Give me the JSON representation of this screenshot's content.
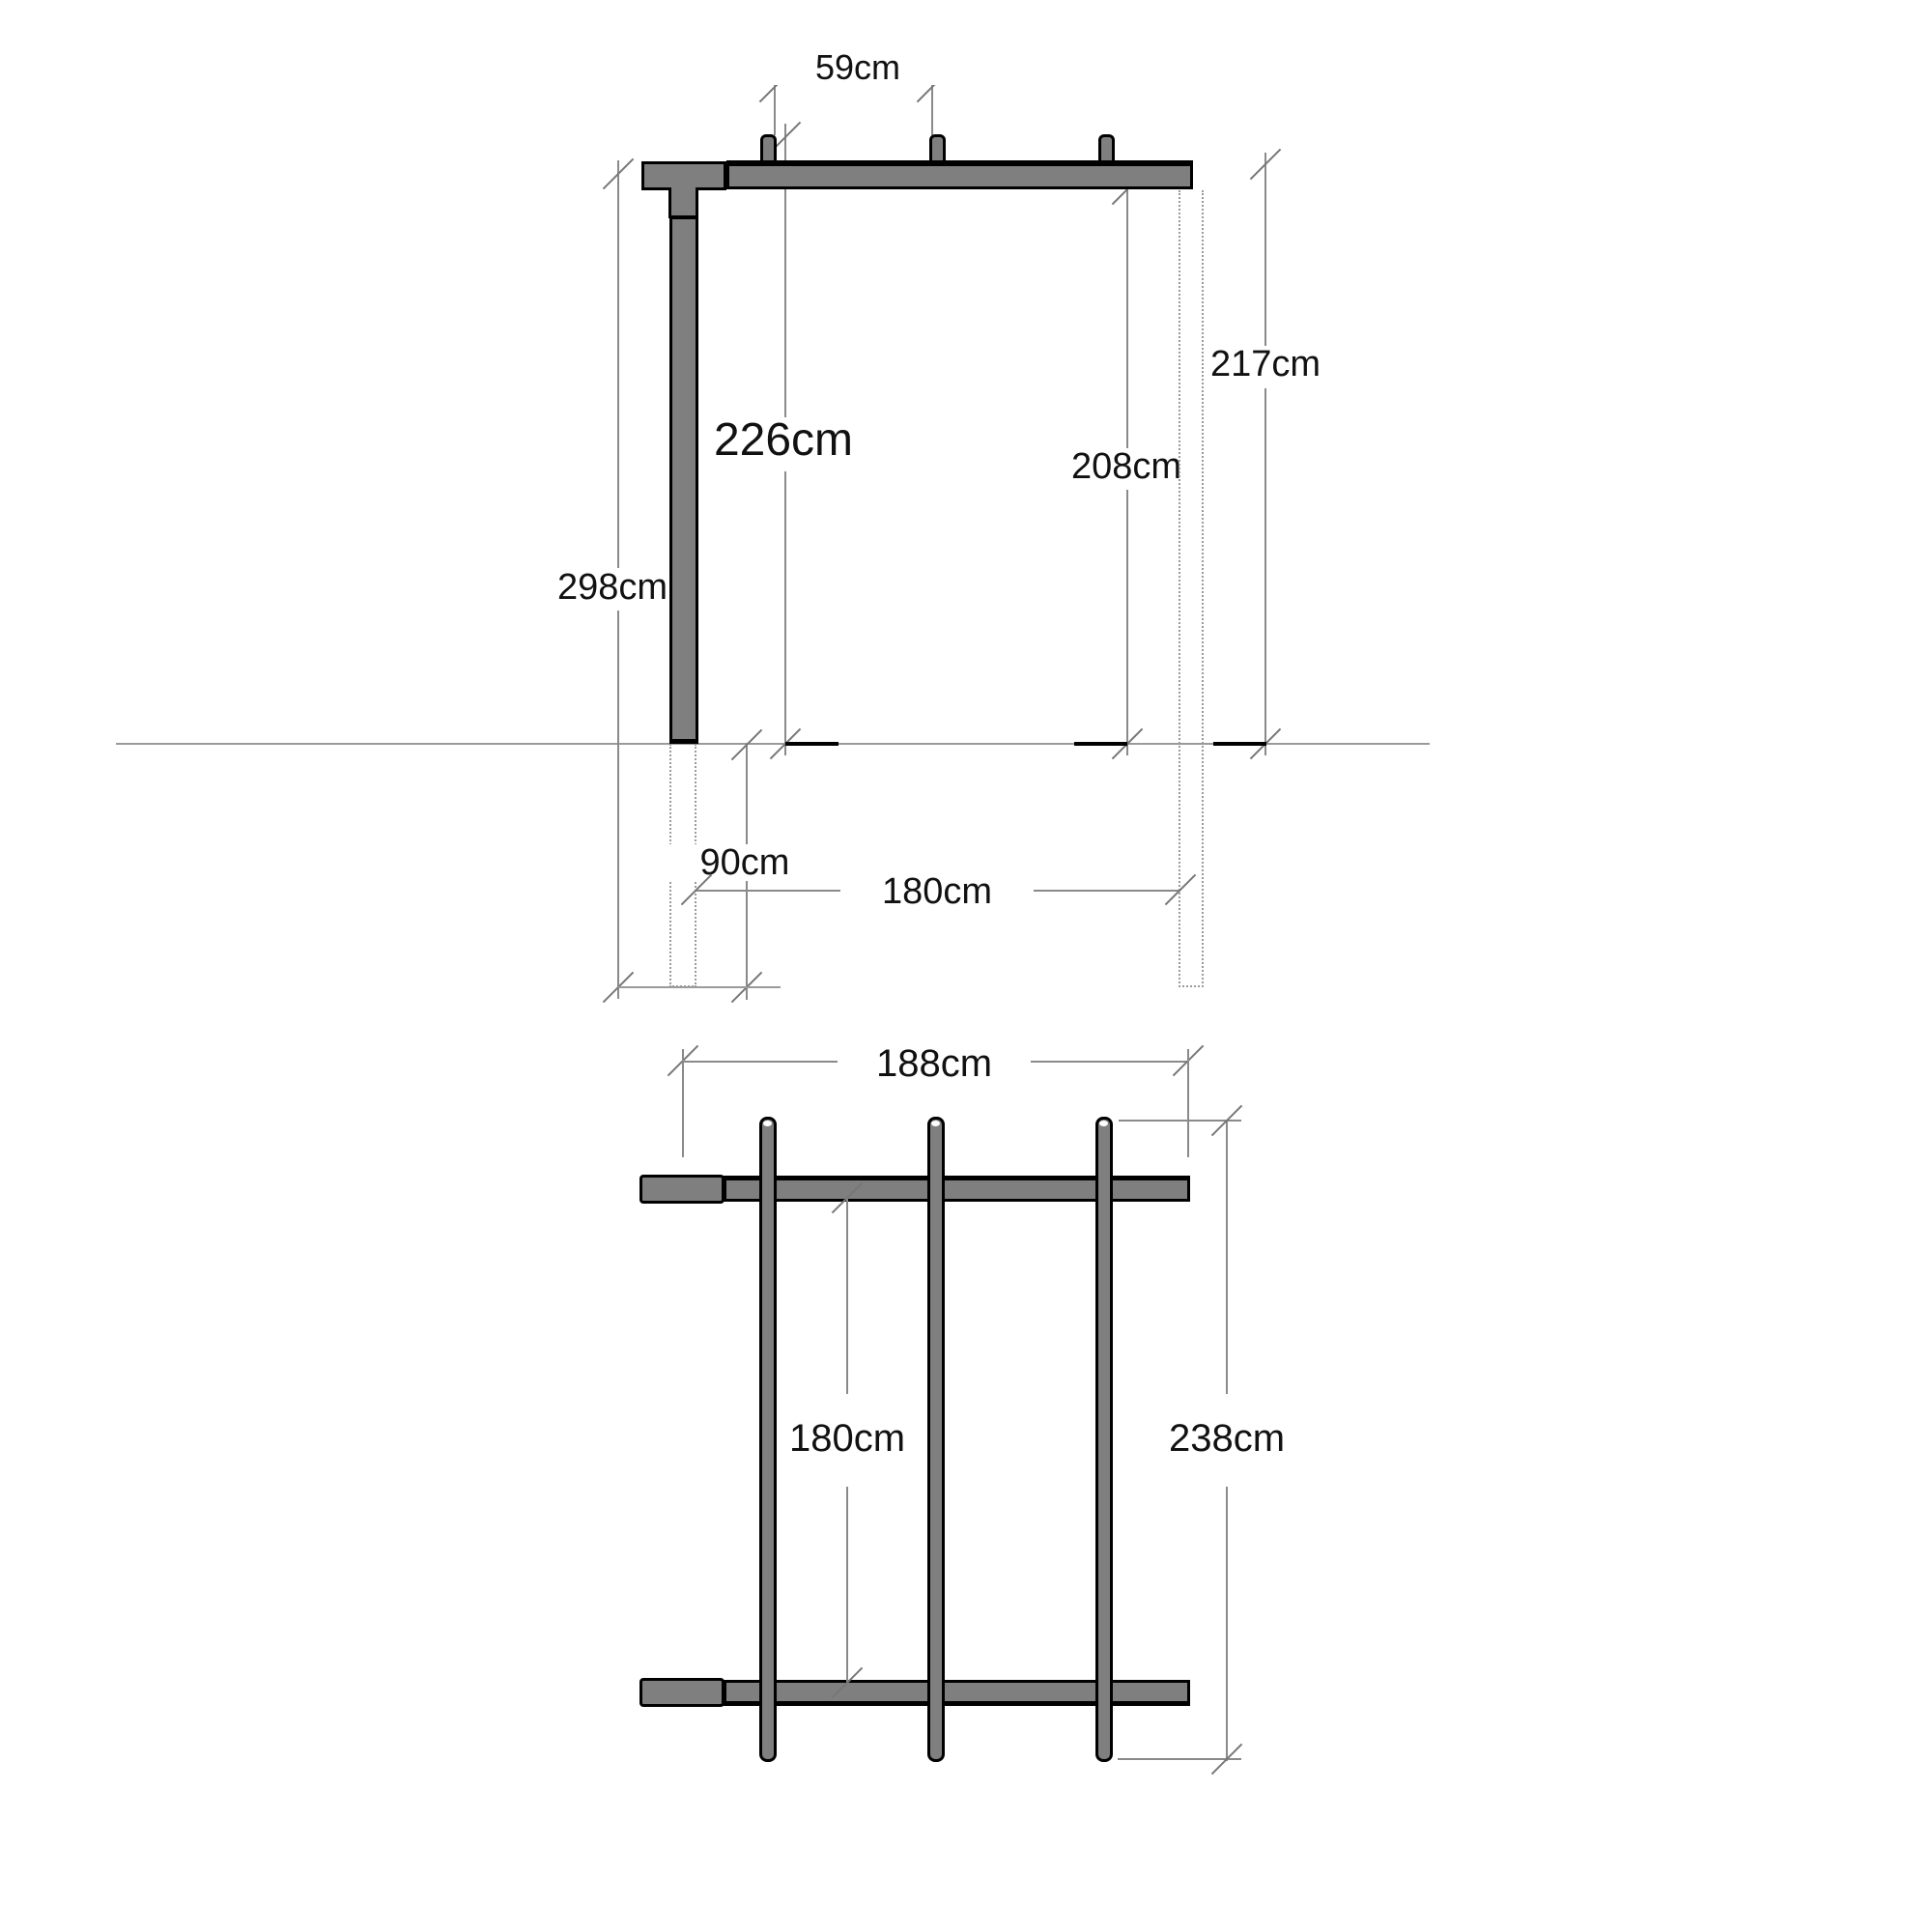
{
  "colors": {
    "wood_fill": "#7f7f7f",
    "outline": "#000000",
    "dimension_line": "#8a8a8a",
    "ground_line": "#9a9a9a",
    "hidden_line": "#9b9b9b",
    "text": "#111111",
    "background": "#ffffff"
  },
  "elevation_view": {
    "rafter_spacing_label": "59cm",
    "beam_underside_height_label": "226cm",
    "post_height_label": "298cm",
    "overall_right_height_label": "217cm",
    "inner_right_height_label": "208cm",
    "ground_offset_label": "90cm",
    "ground_span_label": "180cm"
  },
  "plan_view": {
    "top_span_label": "188cm",
    "inner_span_label": "180cm",
    "depth_label": "238cm"
  }
}
